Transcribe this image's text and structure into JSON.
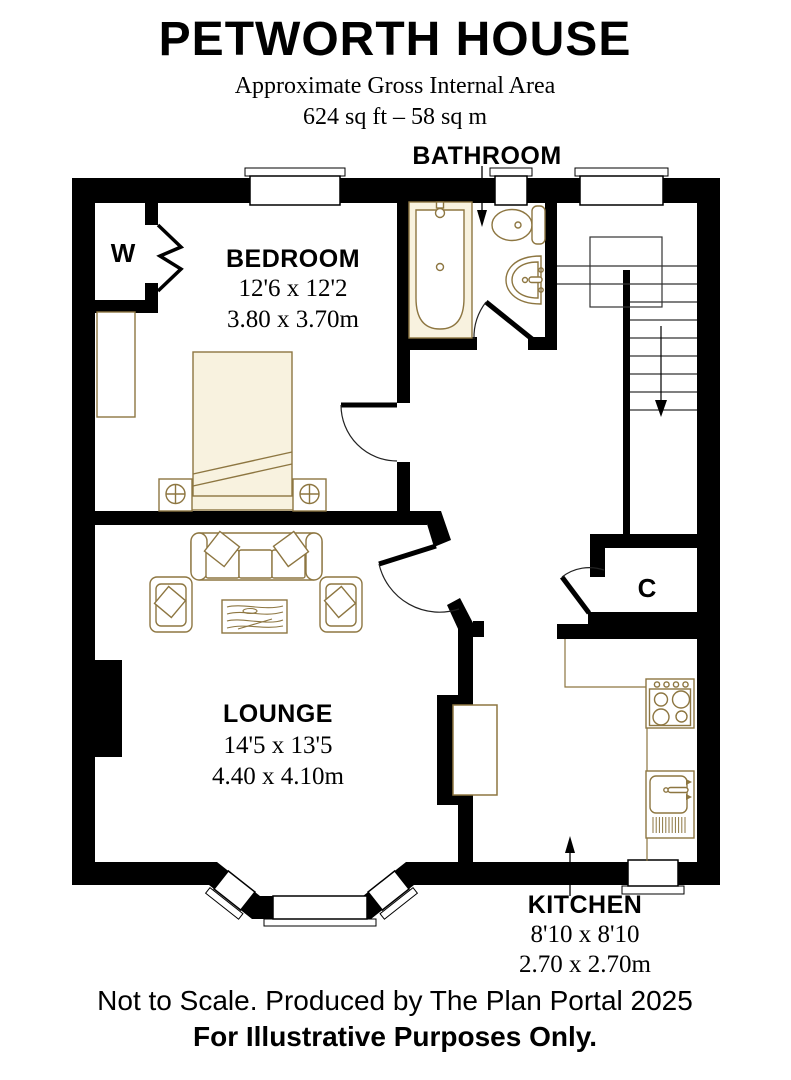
{
  "header": {
    "title": "PETWORTH HOUSE",
    "subtitle": "Approximate Gross Internal Area",
    "area": "624 sq ft – 58 sq m"
  },
  "rooms": {
    "bathroom": {
      "name": "BATHROOM"
    },
    "bedroom": {
      "name": "BEDROOM",
      "imperial": "12'6 x 12'2",
      "metric": "3.80 x 3.70m"
    },
    "lounge": {
      "name": "LOUNGE",
      "imperial": "14'5 x 13'5",
      "metric": "4.40 x 4.10m"
    },
    "kitchen": {
      "name": "KITCHEN",
      "imperial": "8'10 x 8'10",
      "metric": "2.70 x 2.70m"
    },
    "wardrobe": {
      "label": "W"
    },
    "cupboard": {
      "label": "C"
    }
  },
  "footer": {
    "line1": "Not to Scale. Produced by The Plan Portal 2025",
    "line2": "For Illustrative Purposes Only."
  },
  "colors": {
    "wall": "#000000",
    "fixture_outline": "#8d7641",
    "fixture_fill": "#f8f2df",
    "background": "#ffffff"
  }
}
